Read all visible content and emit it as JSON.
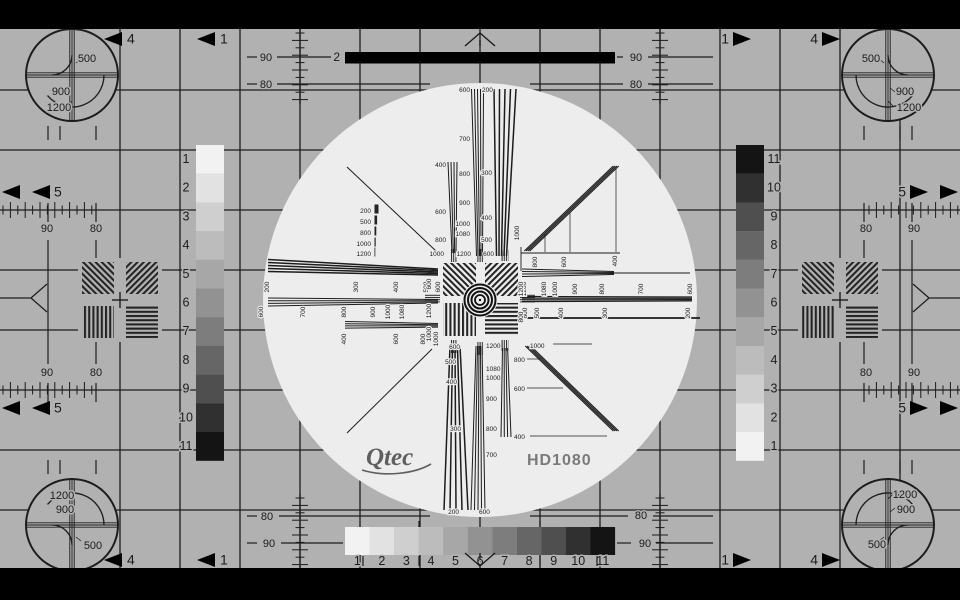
{
  "meta": {
    "name": "HD1080 monoscope television test pattern"
  },
  "logo": {
    "brand": "Qtec",
    "model": "HD1080"
  },
  "colors": {
    "bg": "#b1b1b1",
    "light": "#ededed",
    "ink": "#1c1c1c",
    "black": "#000000",
    "brand": "#5f5f5f",
    "model": "#7a7a7a"
  },
  "bar2": {
    "t": "2"
  },
  "grayscale_left": {
    "numbers": [
      "1",
      "2",
      "3",
      "4",
      "5",
      "6",
      "7",
      "8",
      "9",
      "10",
      "11"
    ],
    "shades": [
      "#f2f2f2",
      "#e2e2e2",
      "#cfcfcf",
      "#bcbcbc",
      "#a7a7a7",
      "#929292",
      "#7d7d7d",
      "#666666",
      "#4f4f4f",
      "#303030",
      "#141414"
    ]
  },
  "grayscale_right": {
    "numbers": [
      "11",
      "10",
      "9",
      "8",
      "7",
      "6",
      "5",
      "4",
      "3",
      "2",
      "1"
    ],
    "shades": [
      "#141414",
      "#303030",
      "#4f4f4f",
      "#666666",
      "#7d7d7d",
      "#929292",
      "#a7a7a7",
      "#bcbcbc",
      "#cfcfcf",
      "#e2e2e2",
      "#f2f2f2"
    ]
  },
  "grayscale_bottom": {
    "numbers": [
      "1",
      "2",
      "3",
      "4",
      "5",
      "6",
      "7",
      "8",
      "9",
      "10",
      "11"
    ],
    "shades": [
      "#f2f2f2",
      "#e2e2e2",
      "#cfcfcf",
      "#bcbcbc",
      "#a7a7a7",
      "#929292",
      "#7d7d7d",
      "#666666",
      "#4f4f4f",
      "#303030",
      "#141414"
    ]
  },
  "corner_circles": {
    "tl": [
      {
        "t": "500",
        "x": 87,
        "y": 62
      },
      {
        "t": "900",
        "x": 61,
        "y": 95
      },
      {
        "t": "1200",
        "x": 59,
        "y": 111
      }
    ],
    "tr": [
      {
        "t": "500",
        "x": 871,
        "y": 62
      },
      {
        "t": "900",
        "x": 905,
        "y": 95
      },
      {
        "t": "1200",
        "x": 909,
        "y": 111
      }
    ],
    "bl": [
      {
        "t": "1200",
        "x": 62,
        "y": 499
      },
      {
        "t": "900",
        "x": 65,
        "y": 513
      },
      {
        "t": "500",
        "x": 93,
        "y": 549
      }
    ],
    "br": [
      {
        "t": "1200",
        "x": 905,
        "y": 498
      },
      {
        "t": "900",
        "x": 906,
        "y": 513
      },
      {
        "t": "500",
        "x": 877,
        "y": 548
      }
    ]
  },
  "arrows": [
    {
      "t": "4",
      "dir": "L",
      "ax": 104,
      "ay": 39,
      "nx": 127
    },
    {
      "t": "1",
      "dir": "L",
      "ax": 197,
      "ay": 39,
      "nx": 220
    },
    {
      "t": "1",
      "dir": "R",
      "ax": 751,
      "ay": 39,
      "nx": 729
    },
    {
      "t": "4",
      "dir": "R",
      "ax": 840,
      "ay": 39,
      "nx": 818
    },
    {
      "t": "4",
      "dir": "L",
      "ax": 104,
      "ay": 560,
      "nx": 127
    },
    {
      "t": "1",
      "dir": "L",
      "ax": 197,
      "ay": 560,
      "nx": 220
    },
    {
      "t": "1",
      "dir": "R",
      "ax": 751,
      "ay": 560,
      "nx": 729
    },
    {
      "t": "4",
      "dir": "R",
      "ax": 840,
      "ay": 560,
      "nx": 818
    },
    {
      "t": "",
      "dir": "L",
      "ax": 2,
      "ay": 192
    },
    {
      "t": "5",
      "dir": "L",
      "ax": 32,
      "ay": 192,
      "nx": 54
    },
    {
      "t": "5",
      "dir": "R",
      "ax": 928,
      "ay": 192,
      "nx": 906
    },
    {
      "t": "",
      "dir": "R",
      "ax": 958,
      "ay": 192
    },
    {
      "t": "",
      "dir": "L",
      "ax": 2,
      "ay": 408
    },
    {
      "t": "5",
      "dir": "L",
      "ax": 32,
      "ay": 408,
      "nx": 54
    },
    {
      "t": "5",
      "dir": "R",
      "ax": 928,
      "ay": 408,
      "nx": 906
    },
    {
      "t": "",
      "dir": "R",
      "ax": 958,
      "ay": 408
    }
  ],
  "scale_labels": [
    {
      "t": "90",
      "x": 266,
      "y": 61
    },
    {
      "t": "90",
      "x": 636,
      "y": 61
    },
    {
      "t": "80",
      "x": 266,
      "y": 88
    },
    {
      "t": "80",
      "x": 636,
      "y": 88
    },
    {
      "t": "80",
      "x": 267,
      "y": 520
    },
    {
      "t": "80",
      "x": 641,
      "y": 519
    },
    {
      "t": "90",
      "x": 269,
      "y": 547
    },
    {
      "t": "90",
      "x": 645,
      "y": 547
    },
    {
      "t": "90",
      "x": 47,
      "y": 232
    },
    {
      "t": "80",
      "x": 96,
      "y": 232
    },
    {
      "t": "90",
      "x": 47,
      "y": 376
    },
    {
      "t": "80",
      "x": 96,
      "y": 376
    },
    {
      "t": "80",
      "x": 866,
      "y": 232
    },
    {
      "t": "90",
      "x": 914,
      "y": 232
    },
    {
      "t": "80",
      "x": 866,
      "y": 376
    },
    {
      "t": "90",
      "x": 914,
      "y": 376
    }
  ],
  "wedge_labels": {
    "north": [
      {
        "t": "600",
        "x": 470,
        "y": 92,
        "a": "end"
      },
      {
        "t": "200",
        "x": 482,
        "y": 92,
        "a": "start"
      },
      {
        "t": "700",
        "x": 470,
        "y": 141,
        "a": "end"
      },
      {
        "t": "400",
        "x": 446,
        "y": 167,
        "a": "end"
      },
      {
        "t": "800",
        "x": 470,
        "y": 176,
        "a": "end"
      },
      {
        "t": "300",
        "x": 492,
        "y": 175,
        "a": "end"
      },
      {
        "t": "900",
        "x": 470,
        "y": 205,
        "a": "end"
      },
      {
        "t": "400",
        "x": 492,
        "y": 220,
        "a": "end"
      },
      {
        "t": "1000",
        "x": 470,
        "y": 226,
        "a": "end"
      },
      {
        "t": "500",
        "x": 492,
        "y": 242,
        "a": "end"
      },
      {
        "t": "1080",
        "x": 470,
        "y": 236,
        "a": "end"
      },
      {
        "t": "600",
        "x": 446,
        "y": 214,
        "a": "end"
      },
      {
        "t": "800",
        "x": 446,
        "y": 242,
        "a": "end"
      },
      {
        "t": "1000",
        "x": 444,
        "y": 256,
        "a": "end"
      },
      {
        "t": "1200",
        "x": 471,
        "y": 256,
        "a": "end"
      },
      {
        "t": "600",
        "x": 494,
        "y": 256,
        "a": "end"
      }
    ],
    "south": [
      {
        "t": "600",
        "x": 460,
        "y": 349,
        "a": "end"
      },
      {
        "t": "1200",
        "x": 486,
        "y": 348,
        "a": "start"
      },
      {
        "t": "500",
        "x": 456,
        "y": 364,
        "a": "end"
      },
      {
        "t": "1080",
        "x": 486,
        "y": 371,
        "a": "start"
      },
      {
        "t": "400",
        "x": 457,
        "y": 384,
        "a": "end"
      },
      {
        "t": "1000",
        "x": 486,
        "y": 380,
        "a": "start"
      },
      {
        "t": "300",
        "x": 461,
        "y": 431,
        "a": "end"
      },
      {
        "t": "900",
        "x": 486,
        "y": 401,
        "a": "start"
      },
      {
        "t": "200",
        "x": 459,
        "y": 514,
        "a": "end"
      },
      {
        "t": "800",
        "x": 486,
        "y": 431,
        "a": "start"
      },
      {
        "t": "700",
        "x": 486,
        "y": 457,
        "a": "start"
      },
      {
        "t": "600",
        "x": 479,
        "y": 514,
        "a": "start"
      },
      {
        "t": "800",
        "x": 514,
        "y": 362,
        "a": "start"
      },
      {
        "t": "600",
        "x": 514,
        "y": 391,
        "a": "start"
      },
      {
        "t": "400",
        "x": 514,
        "y": 439,
        "a": "start"
      },
      {
        "t": "1000",
        "x": 530,
        "y": 348,
        "a": "start"
      }
    ],
    "west_rows": [
      {
        "y": 287,
        "items": [
          {
            "t": "200",
            "x": 269
          },
          {
            "t": "300",
            "x": 358
          },
          {
            "t": "400",
            "x": 398
          },
          {
            "t": "500",
            "x": 428
          },
          {
            "t": "600",
            "x": 440
          }
        ]
      },
      {
        "y": 312,
        "items": [
          {
            "t": "600",
            "x": 263
          },
          {
            "t": "700",
            "x": 305
          },
          {
            "t": "800",
            "x": 346
          },
          {
            "t": "900",
            "x": 375
          },
          {
            "t": "1000",
            "x": 390
          },
          {
            "t": "1080",
            "x": 404
          },
          {
            "t": "1200",
            "x": 432
          }
        ]
      },
      {
        "y": 339,
        "items": [
          {
            "t": "400",
            "x": 346
          },
          {
            "t": "600",
            "x": 398
          },
          {
            "t": "800",
            "x": 425
          },
          {
            "t": "1000",
            "x": 438
          }
        ]
      }
    ],
    "east_rows": [
      {
        "y": 289,
        "items": [
          {
            "t": "1200",
            "x": 526
          },
          {
            "t": "1080",
            "x": 546
          },
          {
            "t": "1000",
            "x": 557
          },
          {
            "t": "900",
            "x": 577
          },
          {
            "t": "800",
            "x": 604
          },
          {
            "t": "700",
            "x": 643
          },
          {
            "t": "600",
            "x": 692
          }
        ]
      },
      {
        "y": 313,
        "items": [
          {
            "t": "600",
            "x": 527
          },
          {
            "t": "500",
            "x": 539
          },
          {
            "t": "400",
            "x": 563
          },
          {
            "t": "300",
            "x": 607
          },
          {
            "t": "200",
            "x": 690
          }
        ]
      }
    ],
    "ne": [
      {
        "t": "1000",
        "x": 519,
        "y": 233
      },
      {
        "t": "800",
        "x": 537,
        "y": 262
      },
      {
        "t": "600",
        "x": 566,
        "y": 262
      },
      {
        "t": "400",
        "x": 617,
        "y": 261
      }
    ],
    "legend": {
      "x": 371,
      "rows": [
        {
          "t": "200",
          "y": 213
        },
        {
          "t": "500",
          "y": 224
        },
        {
          "t": "800",
          "y": 235
        },
        {
          "t": "1000",
          "y": 246
        },
        {
          "t": "1200",
          "y": 256
        }
      ]
    },
    "center": {
      "west": {
        "x": 431,
        "items": [
          {
            "t": "600",
            "y": 284
          },
          {
            "t": "1200",
            "y": 311
          },
          {
            "t": "1000",
            "y": 334
          }
        ]
      },
      "east": {
        "x": 523,
        "items": [
          {
            "t": "1200",
            "y": 289
          },
          {
            "t": "800",
            "y": 317
          }
        ]
      }
    }
  }
}
